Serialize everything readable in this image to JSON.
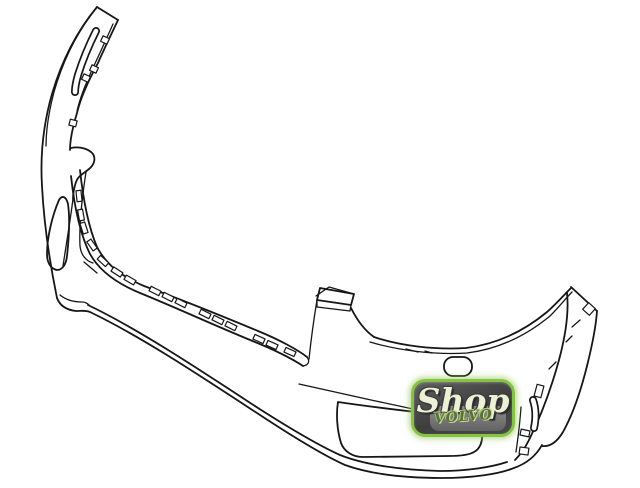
{
  "diagram": {
    "subject": "Front bumper cover line illustration",
    "background": "#ffffff",
    "line_color": "#161616"
  },
  "watermark": {
    "script_text": "Shop",
    "sub_text": "VOLVO",
    "border_color": "#85c441",
    "body_color": "#4b4b4b",
    "script_color": "#ecf0d4",
    "sub_color": "#57742e"
  }
}
